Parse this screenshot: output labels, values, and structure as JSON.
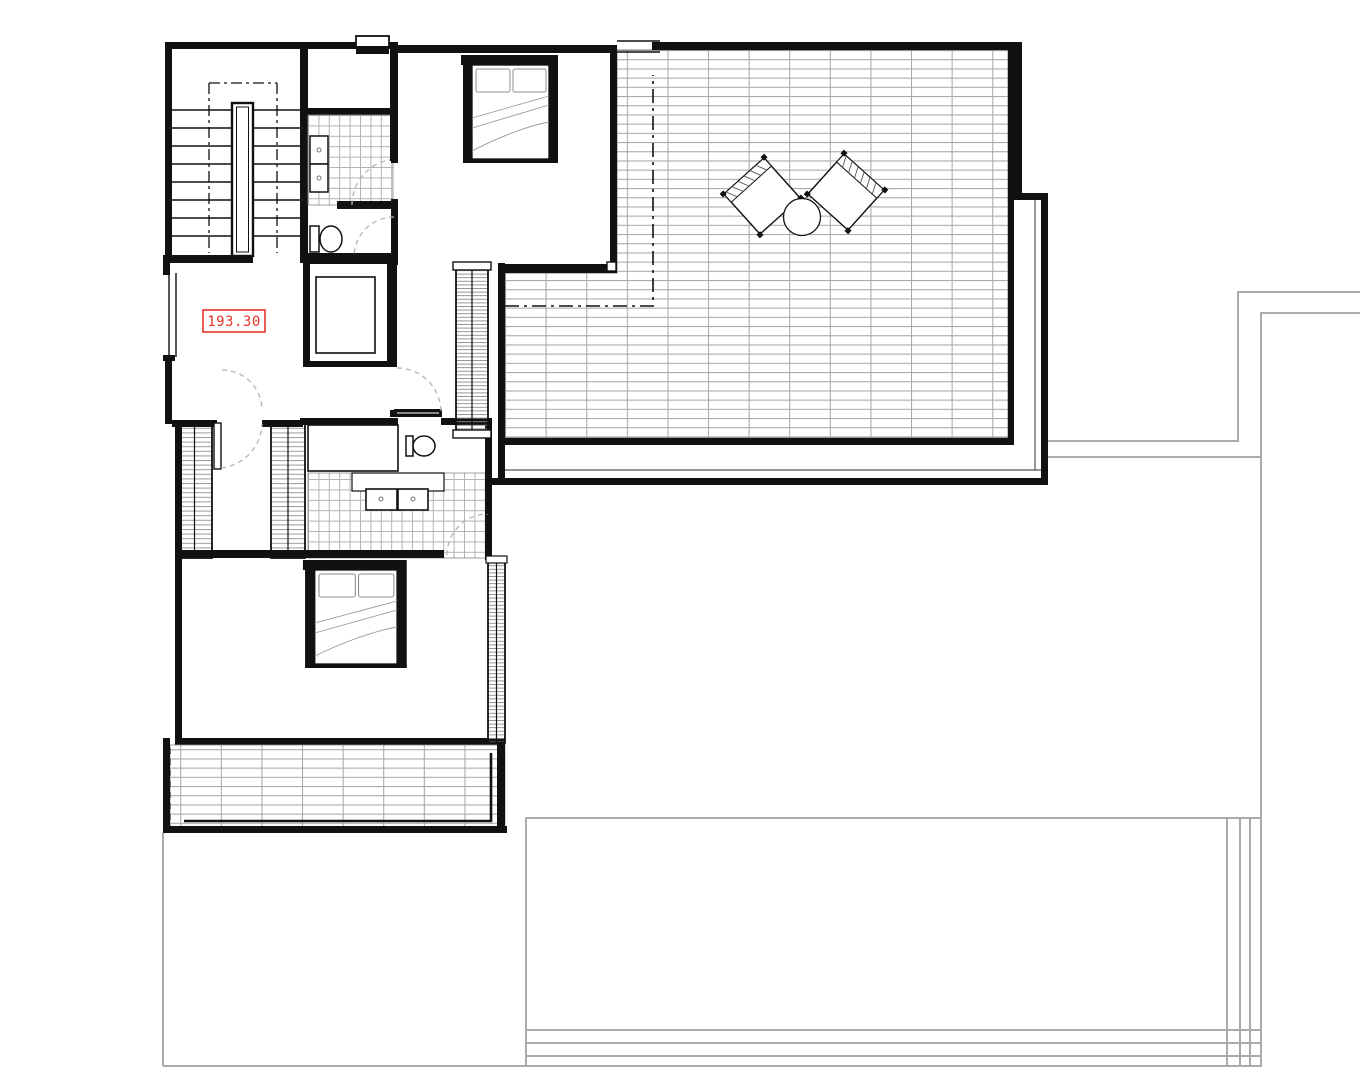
{
  "drawing": {
    "kind": "floor-plan",
    "level_label": {
      "value": "193.30"
    }
  },
  "colors": {
    "wall": "#111111",
    "tile_grid": "#a9a9a9",
    "bath_tile_grid": "#b3b3b3",
    "hatch": "#8a8a8a",
    "label_red": "#e6352b",
    "reference_outline": "#ababab",
    "door_arc": "#b5b5b5"
  },
  "fixtures": [
    "staircase-icon",
    "shower-icon",
    "toilet-icon",
    "sink-icon",
    "double-bed-icon",
    "wardrobe-icon",
    "louver-screen-icon",
    "lounge-chair-icon",
    "side-table-icon",
    "pool-outline"
  ]
}
